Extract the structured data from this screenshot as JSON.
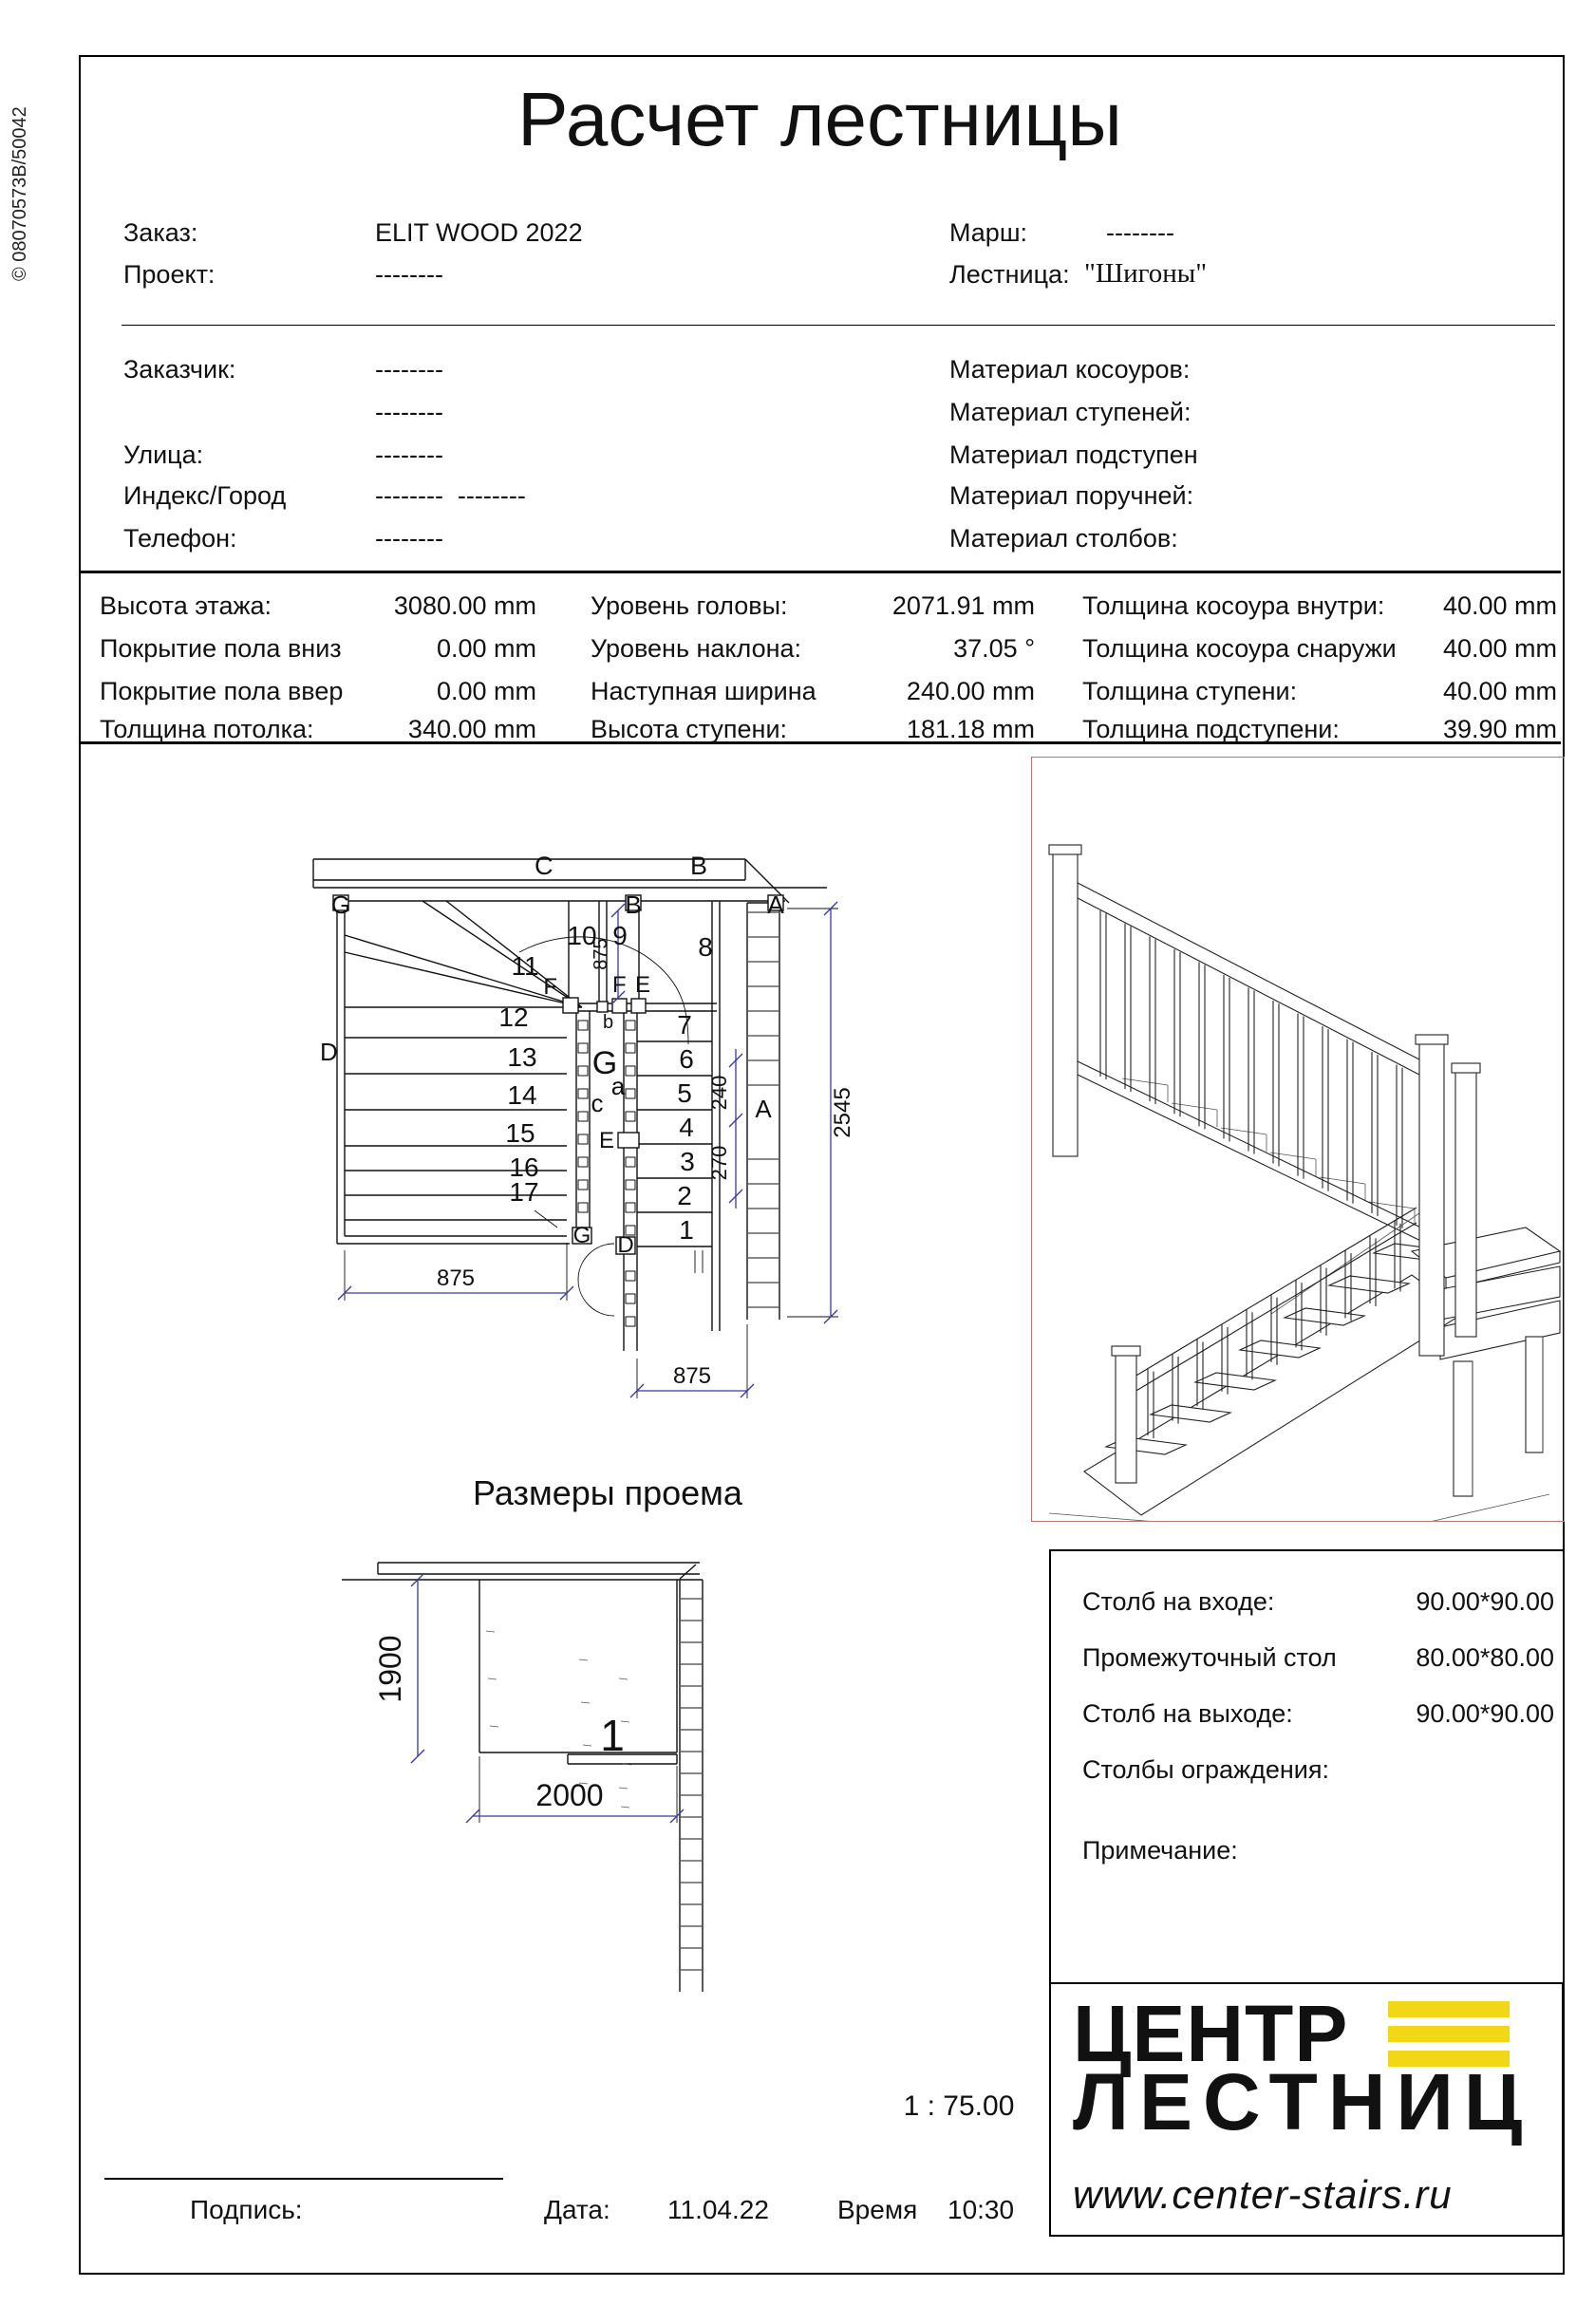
{
  "side_code": "© 08070573B/50042",
  "title": "Расчет лестницы",
  "order_block": {
    "rows": [
      {
        "label": "Заказ:",
        "value": "ELIT WOOD 2022"
      },
      {
        "label": "Проект:",
        "value": "--------"
      }
    ],
    "rows_right": [
      {
        "label": "Марш:",
        "value": "--------"
      },
      {
        "label": "Лестница:",
        "value": "\"Шигоны\""
      }
    ]
  },
  "customer_block": {
    "rows": [
      {
        "label": "Заказчик:",
        "value": "--------"
      },
      {
        "label": "",
        "value": "--------"
      },
      {
        "label": "Улица:",
        "value": "--------"
      },
      {
        "label": "Индекс/Город",
        "value": "--------  --------"
      },
      {
        "label": "Телефон:",
        "value": "--------"
      }
    ]
  },
  "materials_block": {
    "rows": [
      "Материал косоуров:",
      "Материал ступеней:",
      "Материал подступен",
      "Материал поручней:",
      "Материал столбов:"
    ]
  },
  "params_table": {
    "col1": [
      {
        "label": "Высота этажа:",
        "value": "3080.00 mm"
      },
      {
        "label": "Покрытие пола вниз",
        "value": "0.00 mm"
      },
      {
        "label": "Покрытие пола ввер",
        "value": "0.00 mm"
      },
      {
        "label": "Толщина потолка:",
        "value": "340.00 mm"
      }
    ],
    "col2": [
      {
        "label": "Уровень головы:",
        "value": "2071.91 mm"
      },
      {
        "label": "Уровень наклона:",
        "value": "37.05 °"
      },
      {
        "label": "Наступная ширина",
        "value": "240.00 mm"
      },
      {
        "label": "Высота ступени:",
        "value": "181.18 mm"
      }
    ],
    "col3": [
      {
        "label": "Толщина косоура внутри:",
        "value": "40.00 mm"
      },
      {
        "label": "Толщина косоура снаружи",
        "value": "40.00 mm"
      },
      {
        "label": "Толщина ступени:",
        "value": "40.00 mm"
      },
      {
        "label": "Толщина подступени:",
        "value": "39.90 mm"
      }
    ]
  },
  "plan": {
    "steps": [
      "1",
      "2",
      "3",
      "4",
      "5",
      "6",
      "7",
      "8",
      "9",
      "10",
      "11",
      "12",
      "13",
      "14",
      "15",
      "16",
      "17"
    ],
    "letters": {
      "c_top": "C",
      "b_top": "B",
      "g1": "G",
      "b1": "B",
      "a1": "A",
      "d1": "D",
      "f1": "F",
      "b_small": "b",
      "f2": "F",
      "e1": "E",
      "e2": "E",
      "g_big": "G",
      "c_small": "c",
      "a_small": "a",
      "g2": "G",
      "d2": "D",
      "a2": "A"
    },
    "dims": {
      "v875": "875",
      "bl875": "875",
      "br875": "875",
      "h2545": "2545",
      "d240": "240",
      "d270": "270"
    }
  },
  "opening": {
    "title": "Размеры проема",
    "height_dim": "1900",
    "width_dim": "2000",
    "number": "1"
  },
  "posts_box": {
    "rows": [
      {
        "label": "Столб на входе:",
        "value": "90.00*90.00"
      },
      {
        "label": "Промежуточный стол",
        "value": "80.00*80.00"
      },
      {
        "label": "Столб на выходе:",
        "value": "90.00*90.00"
      },
      {
        "label": "Столбы ограждения:",
        "value": ""
      },
      {
        "label": "Примечание:",
        "value": ""
      }
    ]
  },
  "scale_text": "1 : 75.00",
  "logo": {
    "line1": "ЦЕНТР",
    "line2": "ЛЕСТНИЦ",
    "url": "www.center-stairs.ru",
    "accent_color": "#f2d716"
  },
  "footer": {
    "signature_label": "Подпись:",
    "date_label": "Дата:",
    "date_value": "11.04.22",
    "time_label": "Время",
    "time_value": "10:30"
  }
}
